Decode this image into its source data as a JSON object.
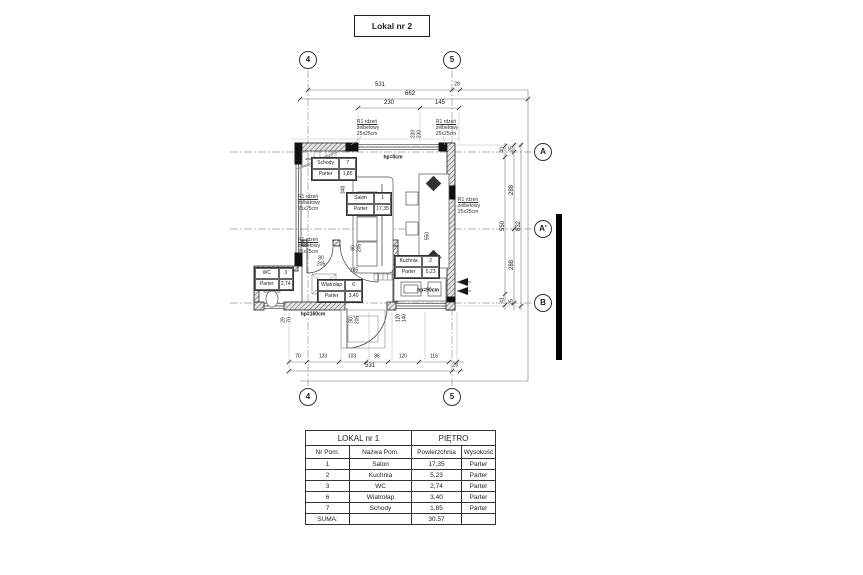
{
  "title": "Lokal nr 2",
  "grid": {
    "cols": [
      "4",
      "5"
    ],
    "rows": [
      "A",
      "A'",
      "B"
    ]
  },
  "dims": {
    "top": {
      "total": "531",
      "edge": "29",
      "overall": "662",
      "seg1": "230",
      "seg2": "145"
    },
    "bottom": {
      "segs": [
        "70",
        "123",
        "103",
        "86",
        "120",
        "116"
      ],
      "total": "531",
      "edge": "29"
    },
    "right": {
      "e1": "40",
      "e2": "25",
      "s1": "288",
      "t1": "550",
      "t2": "632",
      "s2": "288",
      "e3": "41",
      "e4": "25"
    },
    "plan": {
      "d348": "348",
      "d185": "185",
      "d262": "262",
      "d550": "550"
    }
  },
  "openings": {
    "top_window": {
      "w": "230",
      "h": "230"
    },
    "wc_door": {
      "w": "80",
      "h": "205"
    },
    "salon_door": {
      "w": "90",
      "h": "205"
    },
    "entry_door": {
      "w": "90",
      "h": "205"
    },
    "kitchen_window": {
      "w": "120",
      "h": "140"
    },
    "left_corner": {
      "a": "29",
      "b": "70"
    }
  },
  "annotations": {
    "hp_top": "hp=0cm",
    "hp_left": "hp=160cm",
    "hp_kitchen": "hp=90cm",
    "note_line1": "R1 rdzeń",
    "note_line2": "żelbetowy",
    "note_line3": "25x25cm"
  },
  "rooms": {
    "salon": {
      "name": "Salon",
      "nr": "1",
      "floor": "Parter",
      "area": "17,35"
    },
    "kuchnia": {
      "name": "Kuchnia",
      "nr": "2",
      "floor": "Parter",
      "area": "5,23"
    },
    "wc": {
      "name": "WC",
      "nr": "3",
      "floor": "Parter",
      "area": "2,74"
    },
    "wiatrolap": {
      "name": "Wiatrołap",
      "nr": "6",
      "floor": "Parter",
      "area": "3,40"
    },
    "schody": {
      "name": "Schody",
      "nr": "7",
      "floor": "Parter",
      "area": "1,85"
    }
  },
  "table": {
    "title_left": "LOKAL nr 1",
    "title_right": "PIĘTRO",
    "headers": [
      "Nr Pom.",
      "Nazwa Pom.",
      "Powierzchnia",
      "Wysokość"
    ],
    "rows": [
      [
        "1",
        "Salon",
        "17,35",
        "Parter"
      ],
      [
        "2",
        "Kuchnia",
        "5,23",
        "Parter"
      ],
      [
        "3",
        "WC",
        "2,74",
        "Parter"
      ],
      [
        "6",
        "Wiatrołap",
        "3,40",
        "Parter"
      ],
      [
        "7",
        "Schody",
        "1,85",
        "Parter"
      ]
    ],
    "sum_label": "SUMA:",
    "sum_value": "30.57"
  }
}
